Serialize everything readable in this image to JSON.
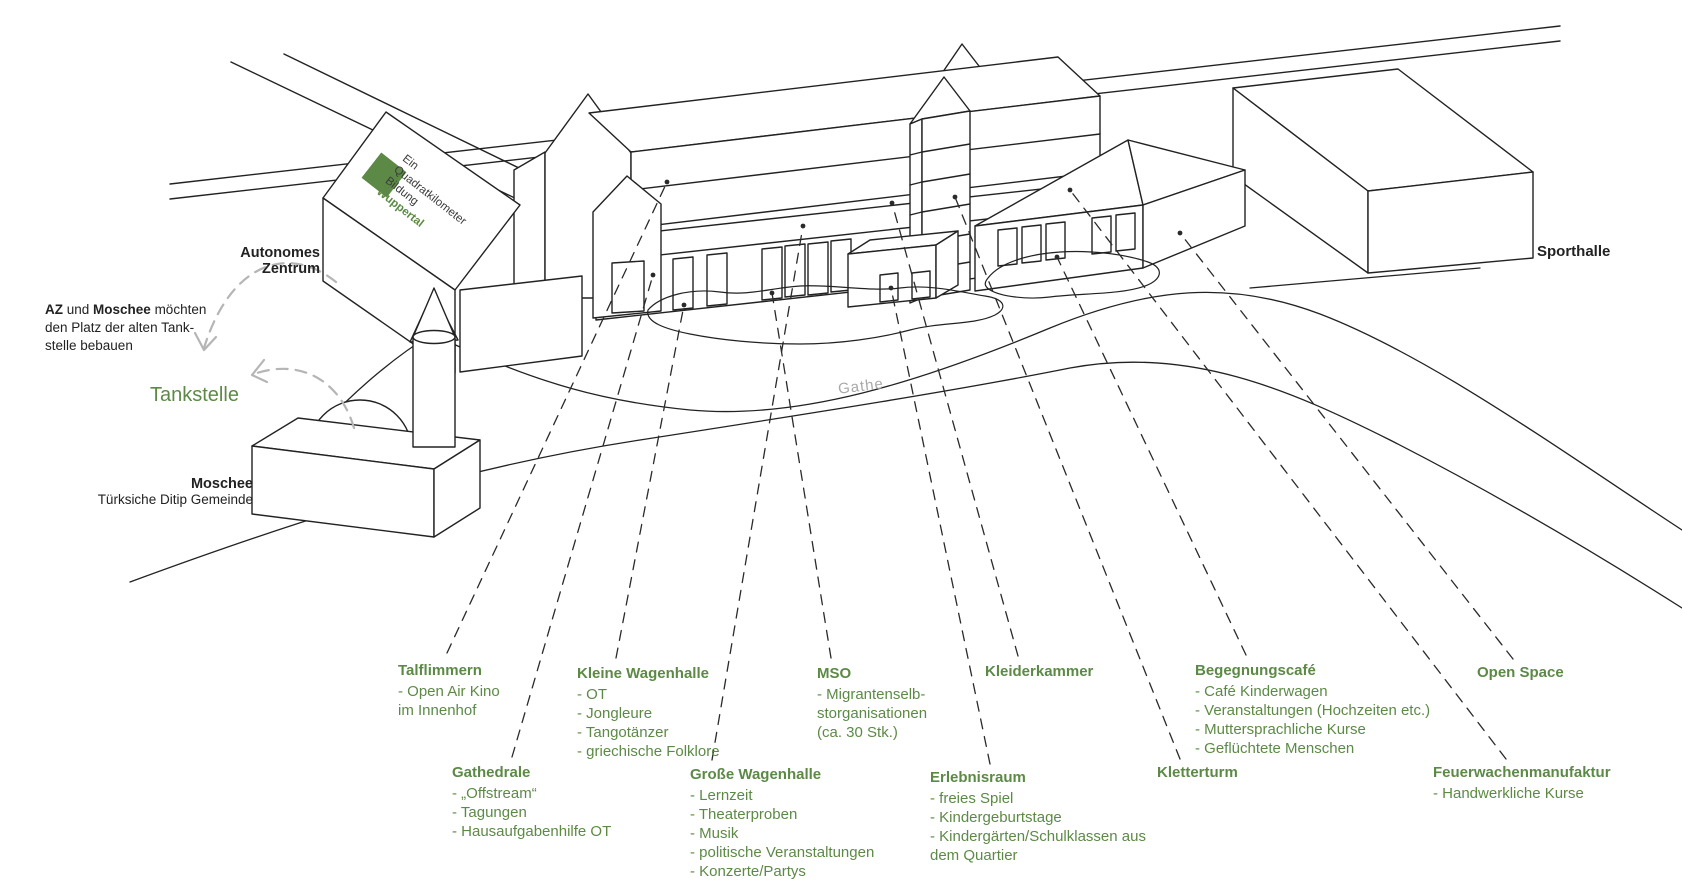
{
  "colors": {
    "accent_green": "#5c8a46",
    "ink": "#222222",
    "arrow_gray": "#b5b5b5",
    "street_gray": "#a9a9a9"
  },
  "branding": {
    "line1": "Ein",
    "line2": "Quadratkilometer",
    "line3": "Bildung",
    "line4": "Wuppertal"
  },
  "buildings": {
    "autonomes_zentrum_line1": "Autonomes",
    "autonomes_zentrum_line2": "Zentrum",
    "tankstelle": "Tankstelle",
    "moschee_title": "Moschee",
    "moschee_subtitle": "Türksiche Ditip Gemeinde",
    "sporthalle": "Sporthalle",
    "street": "Gathe"
  },
  "note": {
    "bold1": "AZ",
    "mid1": " und ",
    "bold2": "Moschee",
    "rest1": " möchten",
    "line2": "den Platz der alten Tank-",
    "line3": "stelle bebauen"
  },
  "annotations": [
    {
      "id": "talflimmern",
      "title": "Talflimmern",
      "items": [
        "- Open Air Kino",
        "im Innenhof"
      ]
    },
    {
      "id": "kleine-wagenhalle",
      "title": "Kleine Wagenhalle",
      "items": [
        "- OT",
        "- Jongleure",
        "- Tangotänzer",
        "- griechische Folklore"
      ]
    },
    {
      "id": "mso",
      "title": "MSO",
      "items": [
        "- Migrantenselb-",
        "storganisationen",
        "(ca. 30 Stk.)"
      ]
    },
    {
      "id": "kleiderkammer",
      "title": "Kleiderkammer",
      "items": []
    },
    {
      "id": "begegnungscafe",
      "title": "Begegnungscafé",
      "items": [
        "- Café Kinderwagen",
        "- Veranstaltungen (Hochzeiten etc.)",
        "- Muttersprachliche Kurse",
        "- Geflüchtete Menschen"
      ]
    },
    {
      "id": "open-space",
      "title": "Open Space",
      "items": []
    },
    {
      "id": "gathedrale",
      "title": "Gathedrale",
      "items": [
        "- „Offstream“",
        "- Tagungen",
        "- Hausaufgabenhilfe OT"
      ]
    },
    {
      "id": "grosse-wagenhalle",
      "title": "Große Wagenhalle",
      "items": [
        "- Lernzeit",
        "- Theaterproben",
        "- Musik",
        "- politische Veranstaltungen",
        "- Konzerte/Partys"
      ]
    },
    {
      "id": "erlebnisraum",
      "title": "Erlebnisraum",
      "items": [
        "- freies Spiel",
        "- Kindergeburtstage",
        "- Kindergärten/Schulklassen aus",
        "dem Quartier"
      ]
    },
    {
      "id": "kletterturm",
      "title": "Kletterturm",
      "items": []
    },
    {
      "id": "feuerwachenmanufaktur",
      "title": "Feuerwachenmanufaktur",
      "items": [
        "- Handwerkliche Kurse"
      ]
    }
  ]
}
